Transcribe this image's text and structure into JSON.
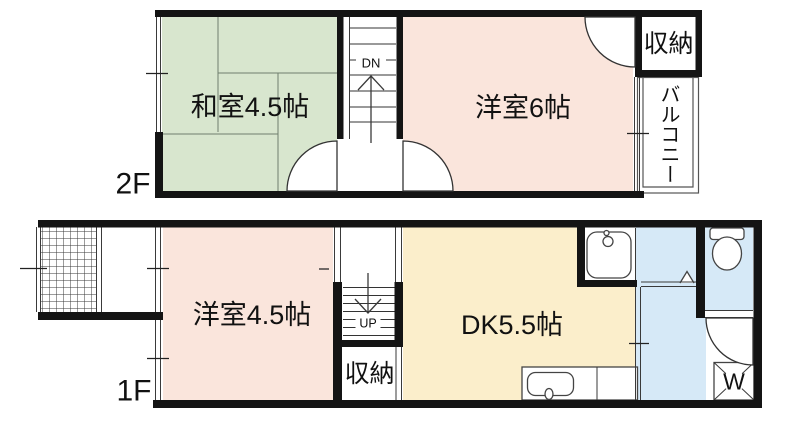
{
  "colors": {
    "tatami_green": "#d8e6ce",
    "room_pink": "#fae5dc",
    "dk_cream": "#fbeecb",
    "wet_blue": "#d6e9f7",
    "wall_black": "#141414"
  },
  "f2": {
    "floor_label": "2F",
    "japanese_room": "和室4.5帖",
    "western_room": "洋室6帖",
    "closet": "収納",
    "balcony": "バルコニー",
    "stair_label": "DN"
  },
  "f1": {
    "floor_label": "1F",
    "western_room": "洋室4.5帖",
    "dining_kitchen": "DK5.5帖",
    "closet": "収納",
    "stair_label": "UP",
    "washer_label": "W"
  }
}
